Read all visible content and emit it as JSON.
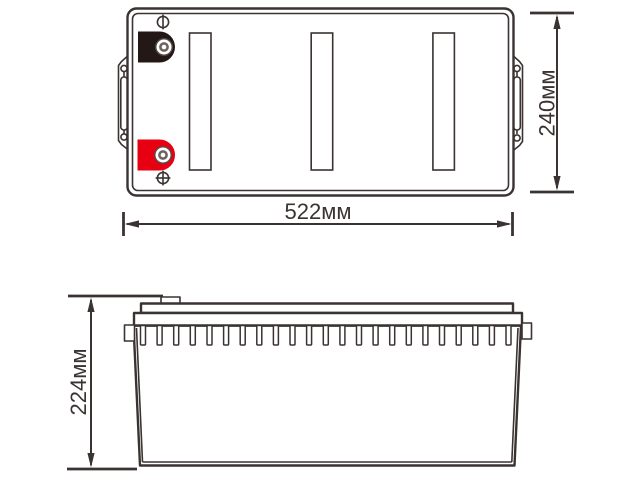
{
  "diagram": {
    "subject": "battery-two-view-dimensional-drawing",
    "dimensions": {
      "width": "522мм",
      "depth": "240мм",
      "height": "224мм"
    },
    "top_view": {
      "vent_strips_count": 3,
      "negative_marker_icon": "circle-with-vertical-bar",
      "positive_marker_icon": "circle-with-cross"
    },
    "side_view": {
      "ribs_count": 23
    },
    "colors": {
      "line": "#3a3332",
      "negative_terminal": "#231815",
      "positive_terminal": "#e60012",
      "background": "#ffffff"
    }
  }
}
